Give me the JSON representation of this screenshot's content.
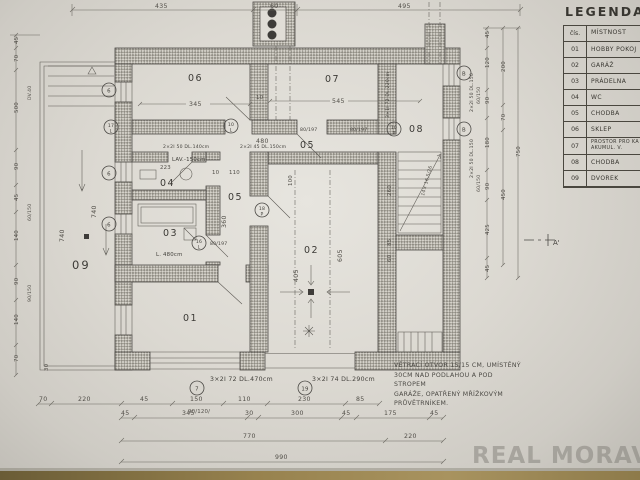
{
  "document": {
    "watermark": "REAL MORAVIA"
  },
  "legend": {
    "title": "LEGENDA",
    "col_num": "čís.",
    "col_name": "MÍSTNOST",
    "rows": [
      {
        "num": "01",
        "name": "HOBBY POKOJ"
      },
      {
        "num": "02",
        "name": "GARÁŽ"
      },
      {
        "num": "03",
        "name": "PRÁDELNA"
      },
      {
        "num": "04",
        "name": "WC"
      },
      {
        "num": "05",
        "name": "CHODBA"
      },
      {
        "num": "06",
        "name": "SKLEP"
      },
      {
        "num": "07",
        "name": "PROSTOR PRO KA AKUMUL. V."
      },
      {
        "num": "08",
        "name": "CHODBA"
      },
      {
        "num": "09",
        "name": "DVOREK"
      }
    ]
  },
  "note": {
    "lines": [
      "VĚTRACÍ OTVOR 15/15 CM, UMÍSTĚNÝ",
      "30CM NAD PODLAHOU A POD STROPEM",
      "GARÁŽE, OPATŘENÝ MŘÍŽKOVÝM",
      "PRŮVĚTRNÍKEM."
    ]
  },
  "plan": {
    "rooms": {
      "r1": "01",
      "r2": "02",
      "r3": "03",
      "r4": "04",
      "r5": "05",
      "r6": "06",
      "r7": "07",
      "r8": "08",
      "r9": "09"
    },
    "dims": {
      "d345": "345",
      "d545": "545",
      "d10": "10",
      "d480": "480",
      "d110": "110",
      "d360": "360",
      "d223": "223",
      "d405": "405",
      "d605": "605",
      "d100": "100",
      "d740": "740",
      "d260": "260",
      "d85": "85",
      "d60": "60",
      "d30": "30"
    },
    "ann": {
      "lav": "LAV.-150cm",
      "tub": "L. 480cm",
      "stairs": "14× 16,5/26",
      "door": "80/197",
      "sub": "90/120/",
      "sec": "A'"
    },
    "lintels": {
      "a": "2×2I 50 DL.140cm",
      "b": "2×2I 45 DL.150cm",
      "c": "3×2I 72 DL.470cm",
      "d": "3×2I 74 DL.290cm",
      "e": "3×1I 72 DL.220cm",
      "f": "2×2I 50 DL.150"
    },
    "markers": {
      "m6": "6",
      "m7": "7",
      "m10": "10",
      "m16": "16",
      "m17": "17",
      "m18": "18",
      "m19": "19",
      "mB": "B",
      "L": "L",
      "P": "P"
    }
  },
  "dims": {
    "top": [
      "435",
      "60",
      "495"
    ],
    "bottom1": [
      "70",
      "220",
      "45",
      "150",
      "110",
      "230",
      "85"
    ],
    "bottom2": [
      "45",
      "345",
      "30",
      "300",
      "45",
      "175",
      "45"
    ],
    "bottom3": [
      "770",
      "220"
    ],
    "bottom4": [
      "990"
    ],
    "right_inner": [
      "45",
      "120",
      "90",
      "180",
      "90",
      "425",
      "45"
    ],
    "right_mid": [
      "200",
      "70",
      "450"
    ],
    "right_outer": [
      "750"
    ],
    "right_notes": [
      "60/150",
      "60/150"
    ],
    "left_outer": [
      "45",
      "70",
      "500",
      "90",
      "45",
      "140",
      "90",
      "140",
      "70"
    ],
    "left_notes": [
      "DV.40",
      "60/150",
      "90/150"
    ],
    "left_extra": [
      "740",
      "30"
    ]
  }
}
